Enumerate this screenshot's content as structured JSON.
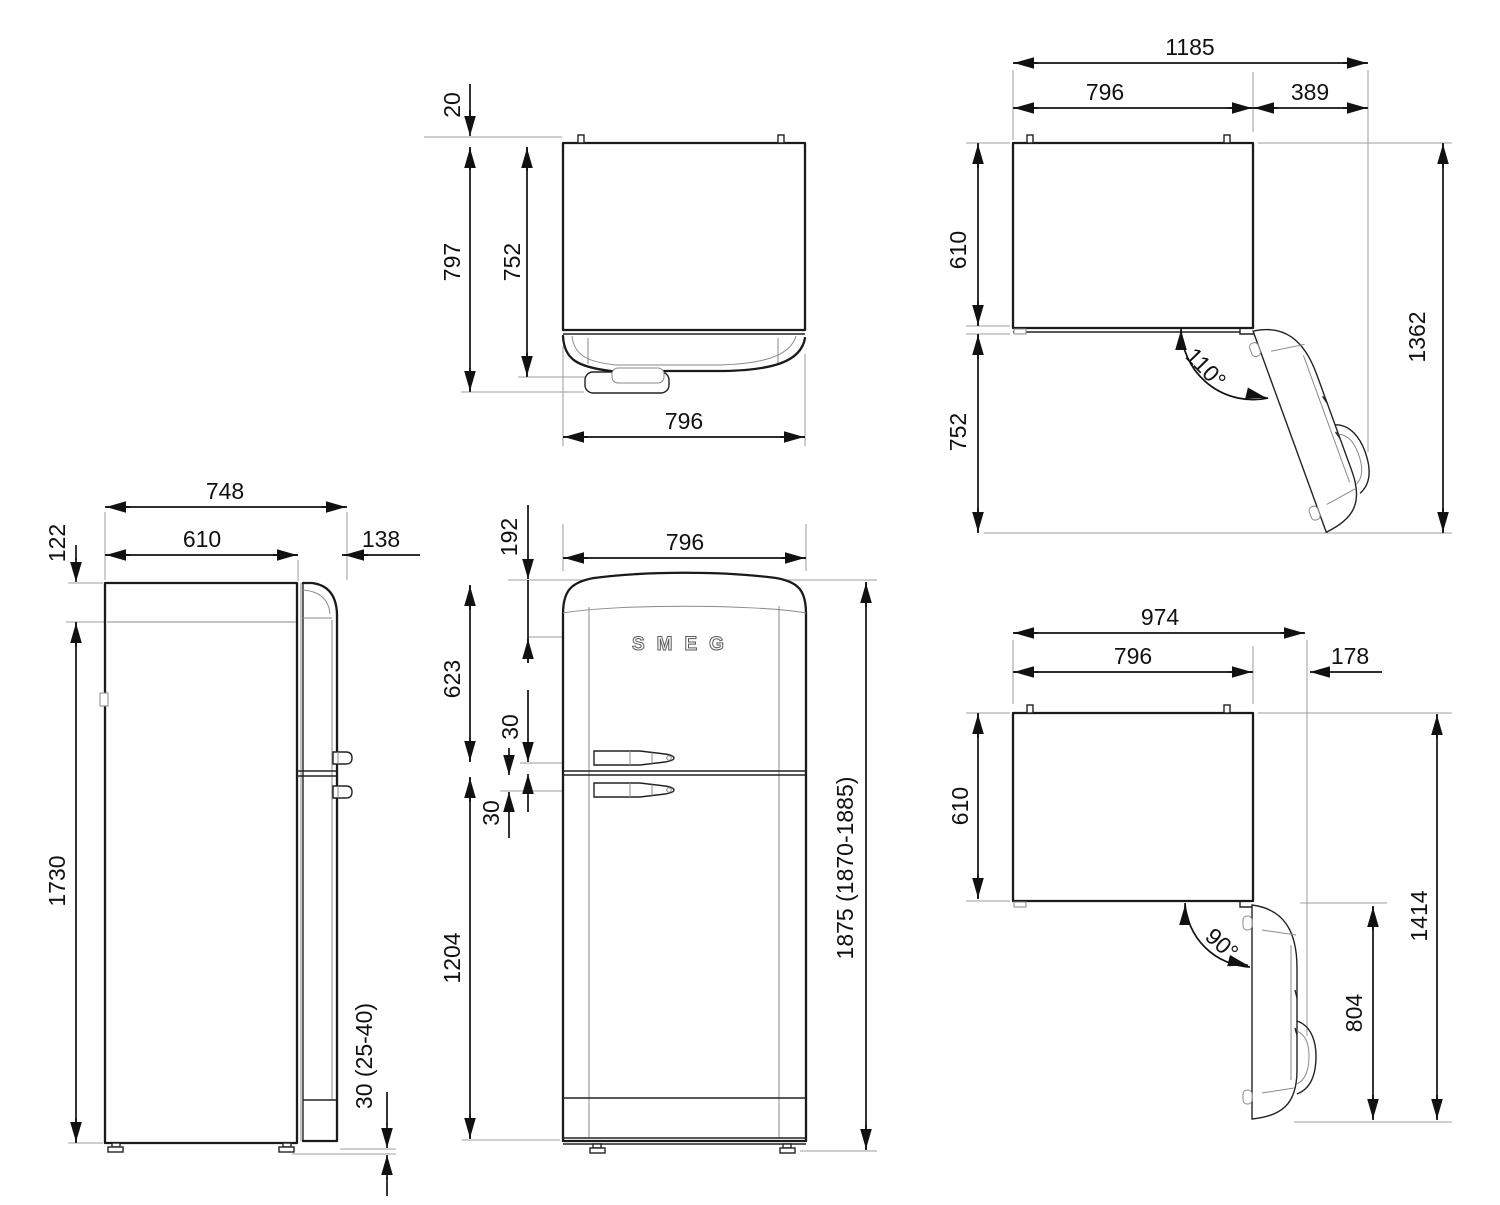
{
  "drawing": {
    "product": "refrigerator-dimension-drawing",
    "brand_logo": "SMEG",
    "colors": {
      "line": "#1a1a1a",
      "dimension": "#111111",
      "extension": "#9d9d9d",
      "background": "#ffffff"
    },
    "views": {
      "top": {
        "pin_gap": "20",
        "depth_total": "797",
        "depth_cabinet": "752",
        "width": "796"
      },
      "open110": {
        "width_total": "1185",
        "width_cabinet": "796",
        "clearance": "389",
        "depth_cabinet": "610",
        "door_projection": "752",
        "depth_total_open": "1362",
        "angle": "110°"
      },
      "side": {
        "depth_total": "748",
        "depth_cabinet": "610",
        "door_depth": "138",
        "top_inset": "122",
        "height_cabinet": "1730",
        "feet_height": "30 (25-40)"
      },
      "front": {
        "logo_drop": "192",
        "width": "796",
        "upper_door": "623",
        "handle_gap_upper": "30",
        "handle_gap_lower": "30",
        "lower_door": "1204",
        "height_total": "1875 (1870-1885)"
      },
      "open90": {
        "width_total": "974",
        "width_cabinet": "796",
        "clearance": "178",
        "depth_cabinet": "610",
        "door_projection": "804",
        "depth_total_open": "1414",
        "angle": "90°"
      }
    }
  }
}
